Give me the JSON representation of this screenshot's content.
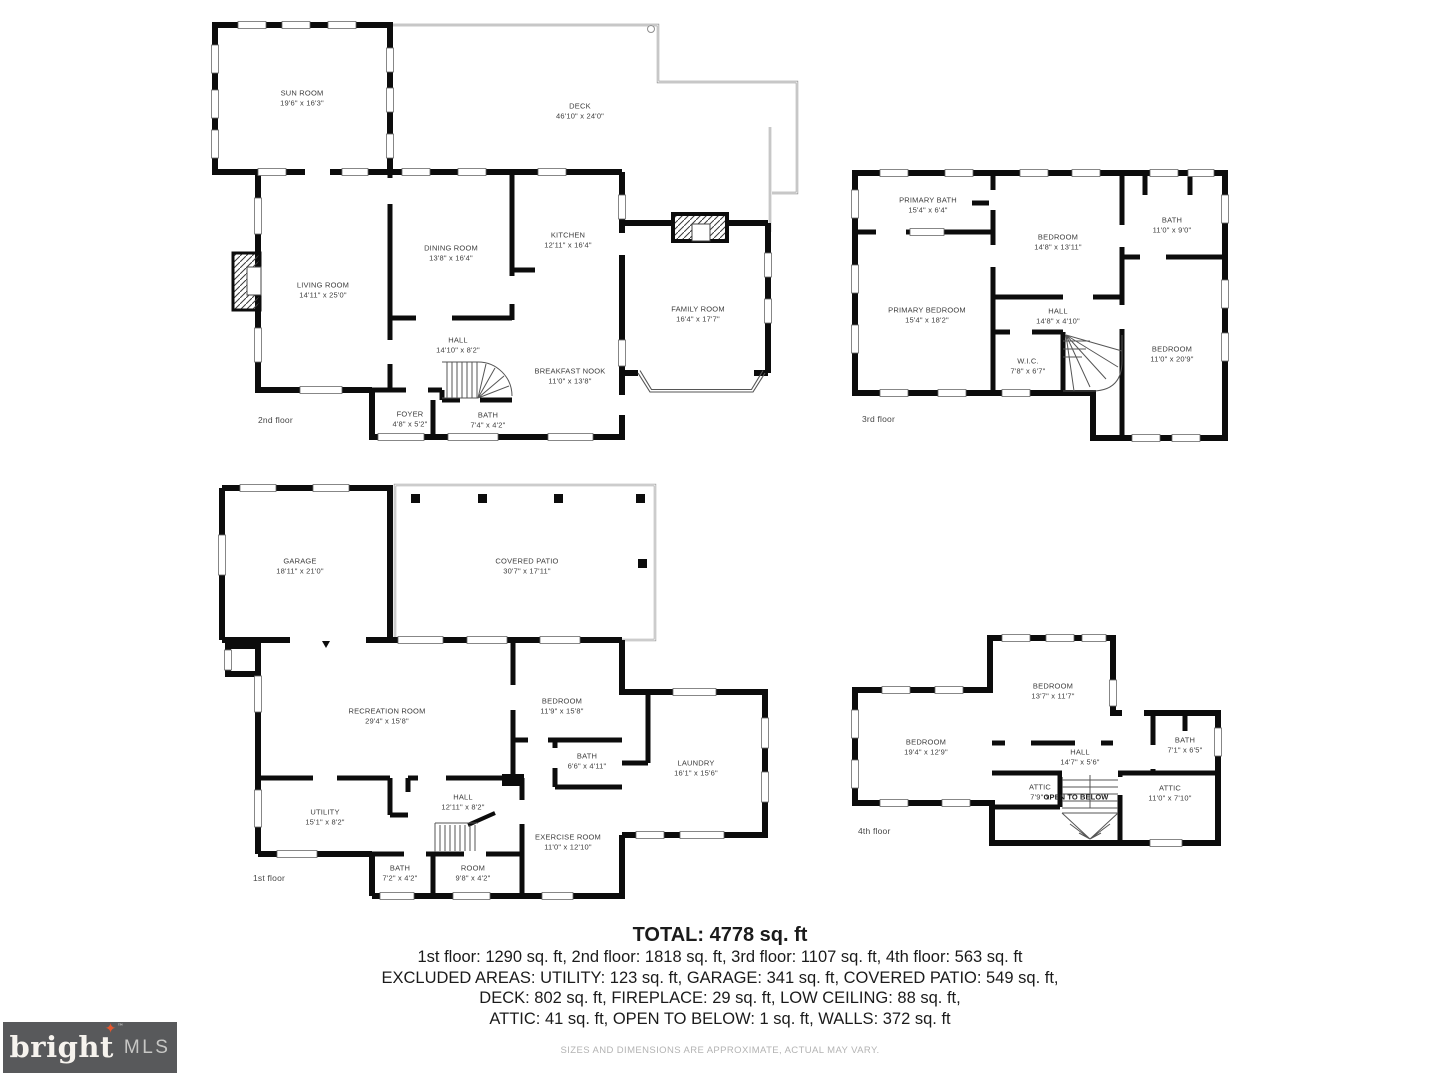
{
  "colors": {
    "wall": "#0c0c0c",
    "room_label": "#3c3c3c",
    "summary_text": "#1b1b1b",
    "disclaimer_text": "#b3b3b3",
    "logo_background": "#58595b",
    "logo_star": "#e4572e",
    "logo_brand_text": "#f6f3ee",
    "logo_mls_text": "#c7c7c5"
  },
  "plans": {
    "floor2": {
      "floor_label": "2nd floor",
      "rooms": [
        {
          "name": "SUN ROOM",
          "dims": "19'6\" x 16'3\""
        },
        {
          "name": "DECK",
          "dims": "46'10\" x 24'0\""
        },
        {
          "name": "LIVING ROOM",
          "dims": "14'11\" x 25'0\""
        },
        {
          "name": "DINING ROOM",
          "dims": "13'8\" x 16'4\""
        },
        {
          "name": "KITCHEN",
          "dims": "12'11\" x 16'4\""
        },
        {
          "name": "FAMILY ROOM",
          "dims": "16'4\" x 17'7\""
        },
        {
          "name": "HALL",
          "dims": "14'10\" x 8'2\""
        },
        {
          "name": "BREAKFAST NOOK",
          "dims": "11'0\" x 13'8\""
        },
        {
          "name": "FOYER",
          "dims": "4'8\" x 5'2\""
        },
        {
          "name": "BATH",
          "dims": "7'4\" x 4'2\""
        }
      ]
    },
    "floor3": {
      "floor_label": "3rd floor",
      "rooms": [
        {
          "name": "PRIMARY BATH",
          "dims": "15'4\" x 6'4\""
        },
        {
          "name": "BEDROOM",
          "dims": "14'8\" x 13'11\""
        },
        {
          "name": "BATH",
          "dims": "11'0\" x 9'0\""
        },
        {
          "name": "PRIMARY BEDROOM",
          "dims": "15'4\" x 18'2\""
        },
        {
          "name": "HALL",
          "dims": "14'8\" x 4'10\""
        },
        {
          "name": "W.I.C.",
          "dims": "7'8\" x 6'7\""
        },
        {
          "name": "BEDROOM",
          "dims": "11'0\" x 20'9\""
        }
      ]
    },
    "floor1": {
      "floor_label": "1st floor",
      "rooms": [
        {
          "name": "GARAGE",
          "dims": "18'11\" x 21'0\""
        },
        {
          "name": "COVERED PATIO",
          "dims": "30'7\" x 17'11\""
        },
        {
          "name": "RECREATION ROOM",
          "dims": "29'4\" x 15'8\""
        },
        {
          "name": "BEDROOM",
          "dims": "11'9\" x 15'8\""
        },
        {
          "name": "BATH",
          "dims": "6'6\" x 4'11\""
        },
        {
          "name": "LAUNDRY",
          "dims": "16'1\" x 15'6\""
        },
        {
          "name": "UTILITY",
          "dims": "15'1\" x 8'2\""
        },
        {
          "name": "HALL",
          "dims": "12'11\" x 8'2\""
        },
        {
          "name": "EXERCISE ROOM",
          "dims": "11'0\" x 12'10\""
        },
        {
          "name": "BATH",
          "dims": "7'2\" x 4'2\""
        },
        {
          "name": "ROOM",
          "dims": "9'8\" x 4'2\""
        }
      ]
    },
    "floor4": {
      "floor_label": "4th floor",
      "open_to_below": "OPEN TO BELOW",
      "rooms": [
        {
          "name": "BEDROOM",
          "dims": "13'7\" x 11'7\""
        },
        {
          "name": "BEDROOM",
          "dims": "19'4\" x 12'9\""
        },
        {
          "name": "HALL",
          "dims": "14'7\" x 5'6\""
        },
        {
          "name": "BATH",
          "dims": "7'1\" x 6'5\""
        },
        {
          "name": "ATTIC",
          "dims": "7'9\" x"
        },
        {
          "name": "ATTIC",
          "dims": "11'0\" x 7'10\""
        }
      ]
    }
  },
  "summary": {
    "total": "TOTAL: 4778 sq. ft",
    "floors": "1st floor: 1290 sq. ft, 2nd floor: 1818 sq. ft, 3rd floor: 1107 sq. ft, 4th floor: 563 sq. ft",
    "excluded1": "EXCLUDED AREAS: UTILITY: 123 sq. ft, GARAGE: 341 sq. ft, COVERED PATIO: 549 sq. ft,",
    "excluded2": "DECK: 802 sq. ft, FIREPLACE: 29 sq. ft, LOW CEILING: 88 sq. ft,",
    "excluded3": "ATTIC: 41 sq. ft, OPEN TO BELOW: 1 sq. ft, WALLS: 372 sq. ft",
    "disclaimer": "SIZES AND DIMENSIONS ARE APPROXIMATE, ACTUAL MAY VARY."
  },
  "logo": {
    "brand": "bright",
    "star": "✦",
    "tm": "™",
    "suffix": "MLS"
  }
}
